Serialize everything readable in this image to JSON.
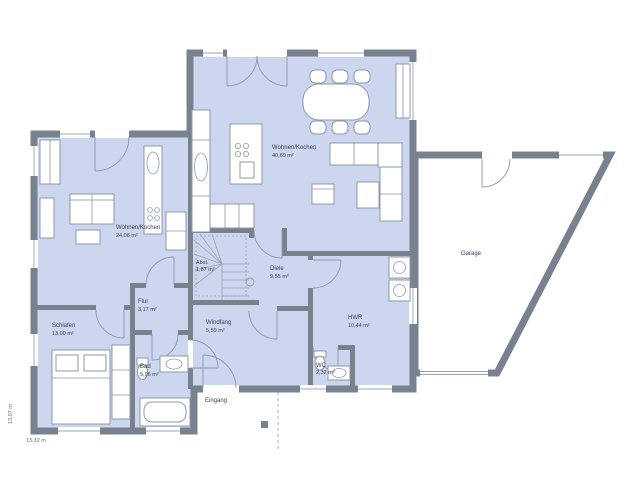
{
  "plan": {
    "type": "floor-plan",
    "colors": {
      "wall": "#78828f",
      "room_fill": "#ccd6ee",
      "garage_fill": "#ffffff",
      "furniture_stroke": "#8e98a8",
      "text": "#3a4150",
      "dashed": "#aab0b8"
    },
    "rooms": [
      {
        "id": "wohnen-kochen-main",
        "name": "Wohnen/Kochen",
        "area": "40,69 m²"
      },
      {
        "id": "wohnen-kochen-left",
        "name": "Wohnen/Kochen",
        "area": "24,08 m²"
      },
      {
        "id": "schlafen",
        "name": "Schlafen",
        "area": "13,00 m²"
      },
      {
        "id": "flur",
        "name": "Flur",
        "area": "3,17 m²"
      },
      {
        "id": "bad",
        "name": "Bad",
        "area": "5,96 m²"
      },
      {
        "id": "windfang",
        "name": "Windfang",
        "area": "5,59 m²"
      },
      {
        "id": "diele",
        "name": "Diele",
        "area": "9,55 m²"
      },
      {
        "id": "hwr",
        "name": "HWR",
        "area": "10,44 m²"
      },
      {
        "id": "wc",
        "name": "WC",
        "area": "2,32 m²"
      },
      {
        "id": "abstellraum",
        "name": "Abst.",
        "area": "1,87 m²"
      },
      {
        "id": "garage",
        "name": "Garage",
        "area": ""
      }
    ],
    "annotations": {
      "entrance": "Eingang",
      "dim_left_vertical": "13,07 m",
      "dim_bottom": "13,32 m"
    }
  }
}
